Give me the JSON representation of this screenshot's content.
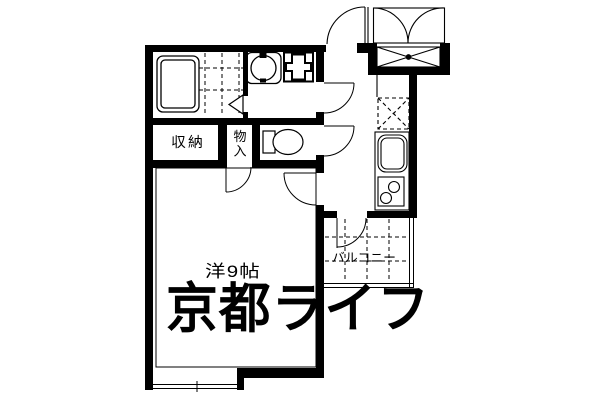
{
  "floorplan": {
    "labels": {
      "storage": "収納",
      "closet": "物入",
      "main_room": "洋9帖",
      "balcony": "バルコニー"
    },
    "watermark": "京都ライフ",
    "colors": {
      "line": "#000000",
      "background": "#ffffff",
      "watermark": "#e2e2e2"
    }
  }
}
